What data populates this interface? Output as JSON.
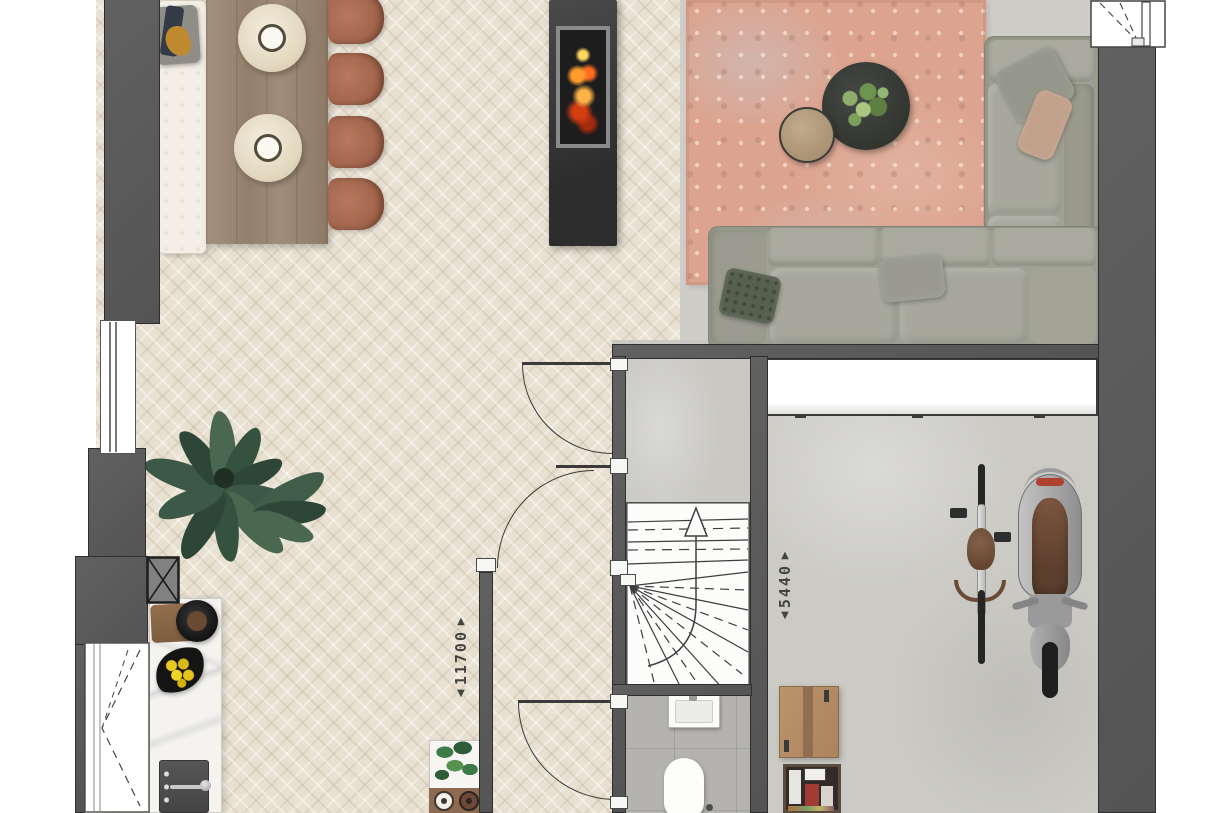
{
  "dimensions": {
    "living": {
      "value": "11700",
      "arrow_up": "▲",
      "arrow_down": "▼"
    },
    "garage": {
      "value": "5440",
      "arrow_up": "▲",
      "arrow_down": "▼"
    }
  },
  "colors": {
    "wall": "#585858",
    "parquet": "#e8e0d1",
    "concrete": "#c9c8c3",
    "bathroom_tile": "#b4b3b0",
    "rug": "#dca48f",
    "sofa": "#a0a193",
    "chair": "#a8674d",
    "table_wood": "#998672",
    "counter_marble": "#f4f3f0",
    "fire": "#ff7a1f",
    "plant": "#3d5846",
    "cardboard": "#b68e66",
    "seat_leather": "#6e4c38"
  }
}
